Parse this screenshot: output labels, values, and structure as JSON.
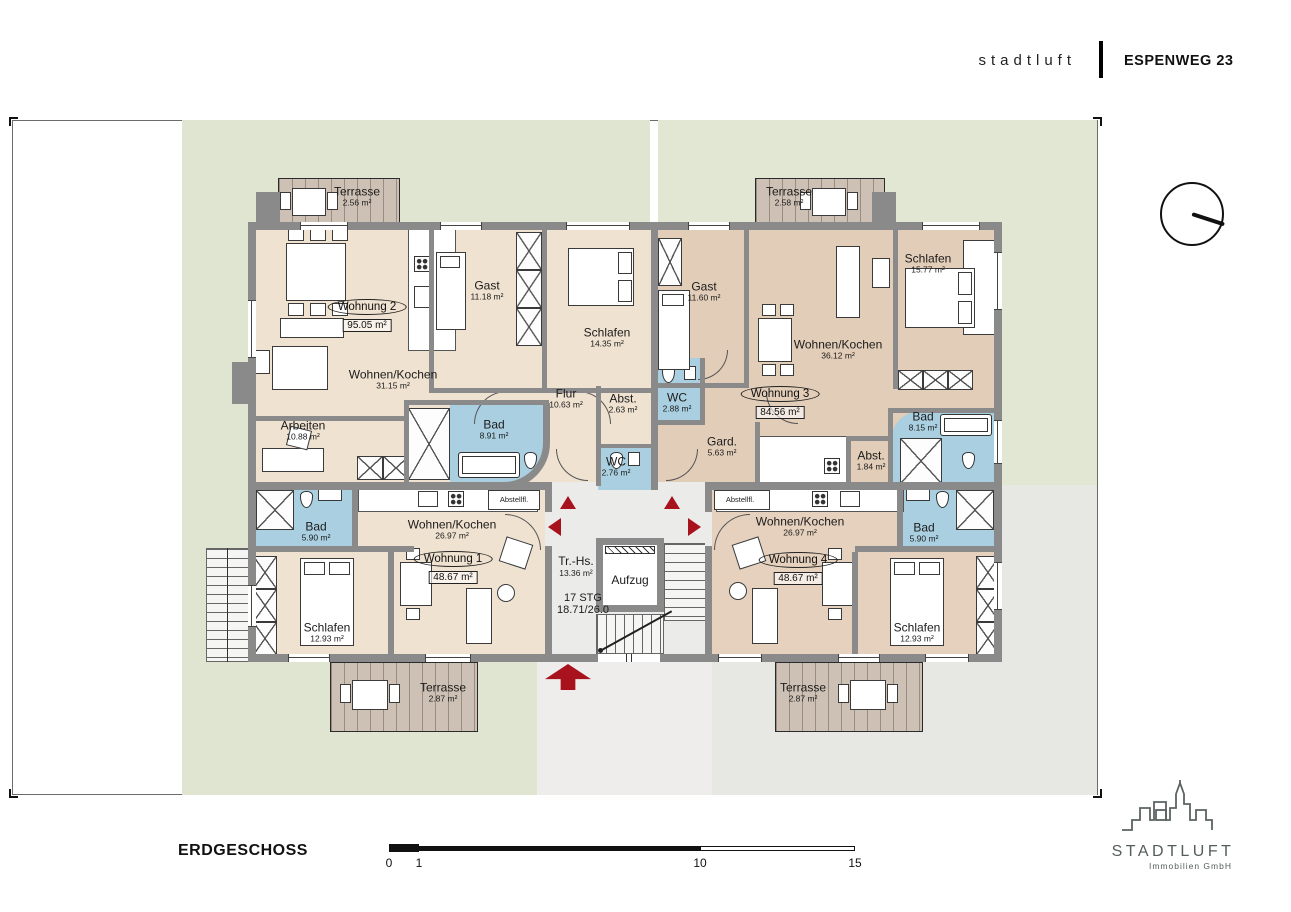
{
  "header": {
    "brand": "stadtluft",
    "project": "ESPENWEG 23"
  },
  "floor": {
    "title": "ERDGESCHOSS"
  },
  "scale_bar": {
    "t0": "0",
    "t1": "1",
    "t10": "10",
    "t15": "15"
  },
  "logo": {
    "name": "STADTLUFT",
    "subtitle": "Immobilien GmbH"
  },
  "stairwell": {
    "name": "Tr.-Hs.",
    "area": "13.36 m²",
    "elevator": "Aufzug",
    "steps": "17 STG",
    "step_ratio": "18.71/26.0"
  },
  "apartments": [
    {
      "badge": "Wohnung 2",
      "area": "95.05 m²"
    },
    {
      "badge": "Wohnung 3",
      "area": "84.56 m²"
    },
    {
      "badge": "Wohnung 1",
      "area": "48.67 m²"
    },
    {
      "badge": "Wohnung 4",
      "area": "48.67 m²"
    }
  ],
  "rooms": [
    {
      "name": "Terrasse",
      "area": "2.56 m²"
    },
    {
      "name": "Terrasse",
      "area": "2.58 m²"
    },
    {
      "name": "Wohnen/Kochen",
      "area": "31.15 m²"
    },
    {
      "name": "Gast",
      "area": "11.18 m²"
    },
    {
      "name": "Schlafen",
      "area": "14.35 m²"
    },
    {
      "name": "Flur",
      "area": "10.63 m²"
    },
    {
      "name": "Abst.",
      "area": "2.63 m²"
    },
    {
      "name": "WC",
      "area": "2.76 m²"
    },
    {
      "name": "Arbeiten",
      "area": "10.88 m²"
    },
    {
      "name": "Bad",
      "area": "8.91 m²"
    },
    {
      "name": "Gast",
      "area": "11.60 m²"
    },
    {
      "name": "Wohnen/Kochen",
      "area": "36.12 m²"
    },
    {
      "name": "Schlafen",
      "area": "15.77 m²"
    },
    {
      "name": "WC",
      "area": "2.88 m²"
    },
    {
      "name": "Gard.",
      "area": "5.63 m²"
    },
    {
      "name": "Bad",
      "area": "8.15 m²"
    },
    {
      "name": "Abst.",
      "area": "1.84 m²"
    },
    {
      "name": "Bad",
      "area": "5.90 m²"
    },
    {
      "name": "Wohnen/Kochen",
      "area": "26.97 m²"
    },
    {
      "name": "Schlafen",
      "area": "12.93 m²"
    },
    {
      "name": "Abstellfl."
    },
    {
      "name": "Terrasse",
      "area": "2.87 m²"
    },
    {
      "name": "Wohnen/Kochen",
      "area": "26.97 m²"
    },
    {
      "name": "Bad",
      "area": "5.90 m²"
    },
    {
      "name": "Schlafen",
      "area": "12.93 m²"
    },
    {
      "name": "Abstellfl."
    },
    {
      "name": "Terrasse",
      "area": "2.87 m²"
    }
  ],
  "colors": {
    "accent_red": "#a8121d",
    "wall_gray": "#8a8a8a",
    "bath_blue": "#a9cfe0",
    "floor_beige": "#efe2d0",
    "floor_tan": "#e2cdb8",
    "site_green": "#dfe5d1",
    "site_gray": "#e7e8e3"
  }
}
